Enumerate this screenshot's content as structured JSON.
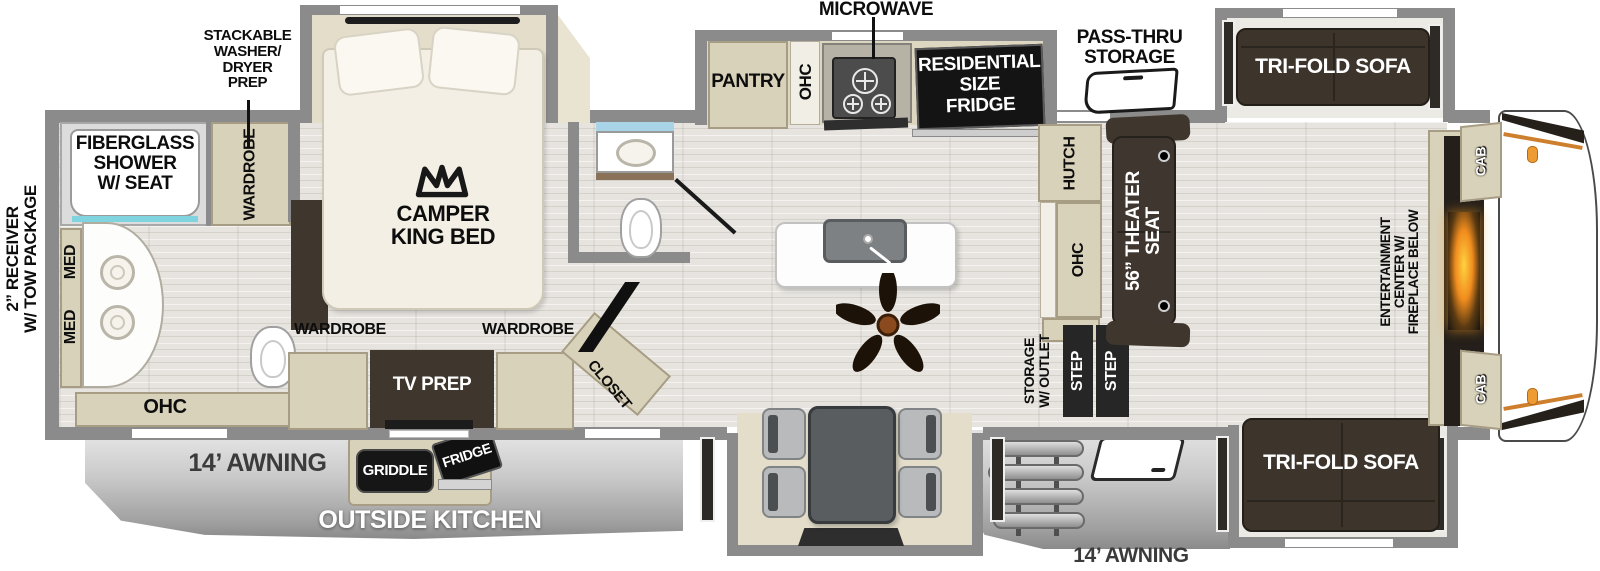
{
  "exterior": {
    "receiver_label": "2” RECEIVER\nW/ TOW PACKAGE",
    "awning_left_label": "14’ AWNING",
    "awning_right_label": "14’ AWNING",
    "outside_kitchen_label": "OUTSIDE KITCHEN",
    "griddle_label": "GRIDDLE",
    "outside_fridge_label": "FRIDGE",
    "pass_thru_label": "PASS-THRU\nSTORAGE"
  },
  "rear_bath": {
    "shower_label": "FIBERGLASS\nSHOWER\nW/ SEAT",
    "wardrobe_label": "WARDROBE",
    "med_upper_label": "MED",
    "med_lower_label": "MED",
    "ohc_label": "OHC"
  },
  "bedroom": {
    "washer_dryer_label": "STACKABLE\nWASHER/\nDRYER\nPREP",
    "bed_label": "CAMPER\nKING BED",
    "wardrobe_left_label": "WARDROBE",
    "wardrobe_right_label": "WARDROBE",
    "tv_prep_label": "TV PREP",
    "closet_label": "CLOSET"
  },
  "kitchen": {
    "pantry_label": "PANTRY",
    "ohc_label": "OHC",
    "microwave_label": "MICROWAVE",
    "fridge_label": "RESIDENTIAL\nSIZE\nFRIDGE"
  },
  "living": {
    "hutch_label": "HUTCH",
    "ohc_label": "OHC",
    "theater_seat_label": "56” THEATER\nSEAT",
    "storage_outlet_label": "STORAGE\nW/ OUTLET",
    "step_rear_label": "STEP",
    "step_front_label": "STEP",
    "sofa_top_label": "TRI-FOLD SOFA",
    "sofa_bottom_label": "TRI-FOLD SOFA",
    "entertainment_label": "ENTERTAINMENT\nCENTER W/\nFIREPLACE BELOW",
    "cab_top_label": "CAB",
    "cab_bottom_label": "CAB"
  },
  "colors": {
    "wall": "#8b8b8b",
    "cabinet": "#d9d2ba",
    "dark_furniture": "#3f372e",
    "appliance_black": "#141414",
    "window_blue": "#a9d3e6",
    "accent_orange": "#ef9b33",
    "skirt_gray": "#b9b9b9"
  }
}
